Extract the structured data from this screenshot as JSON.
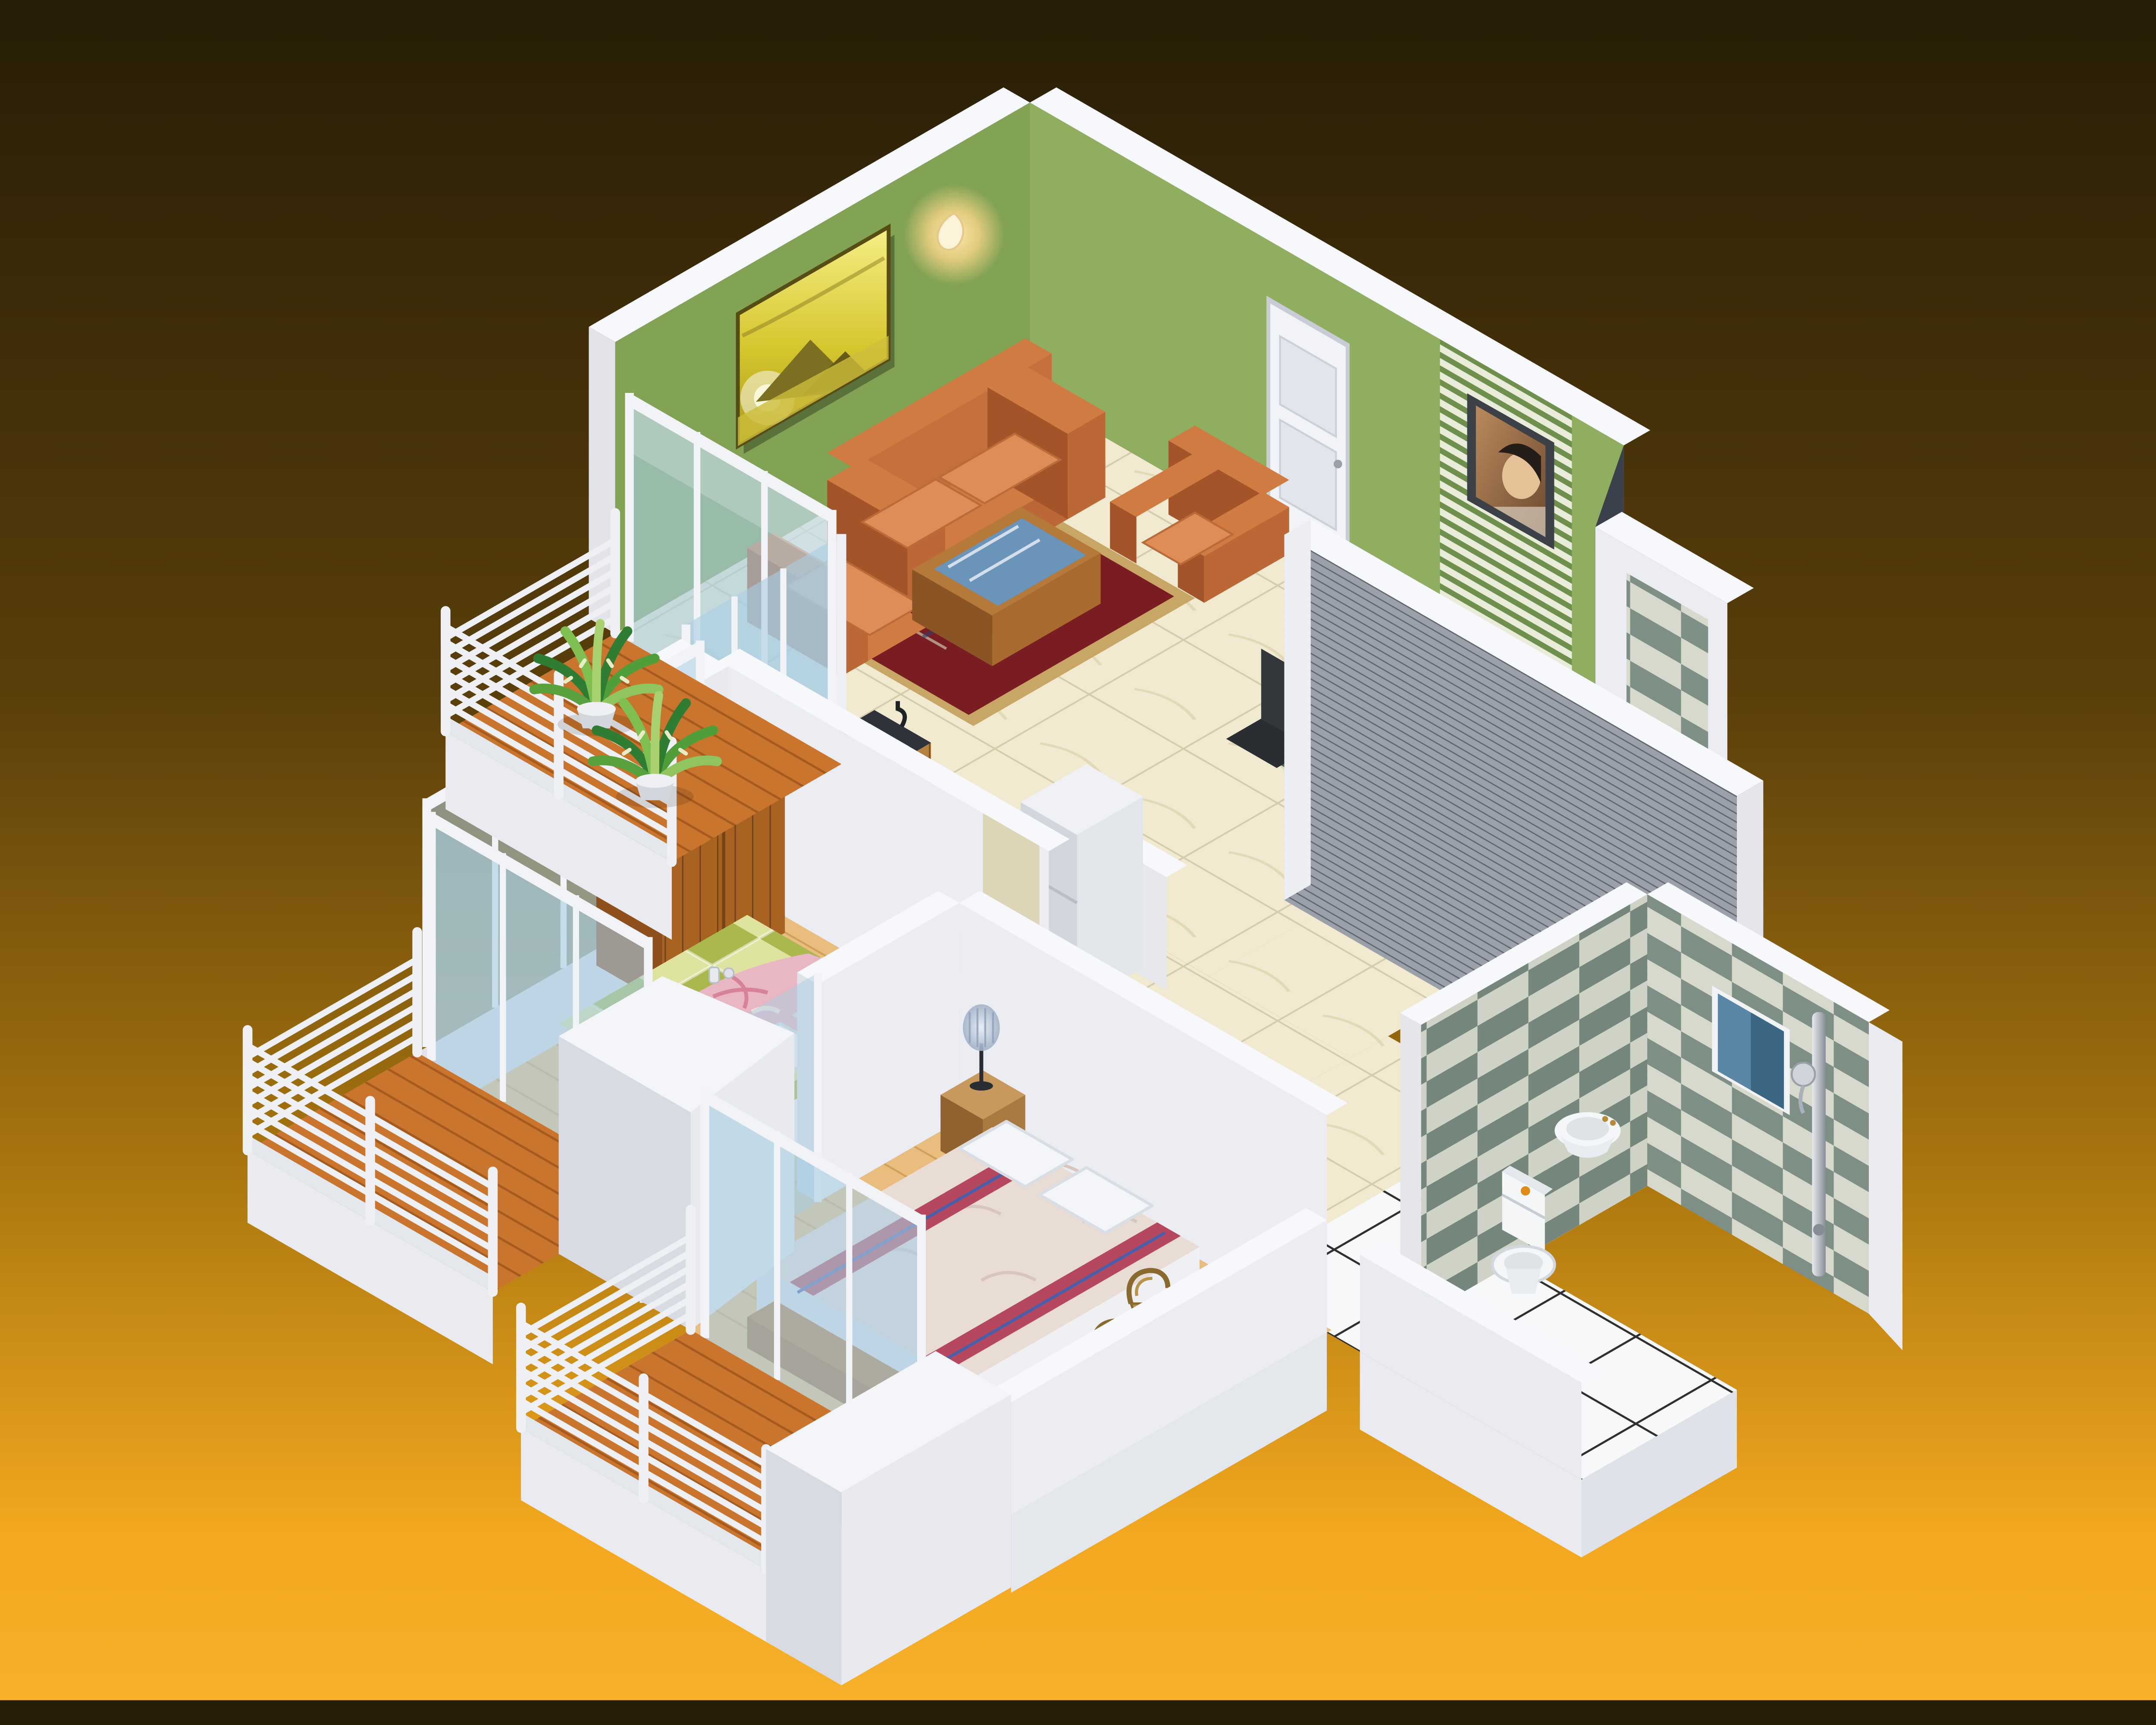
{
  "scene": {
    "type": "3d-isometric-architectural-render",
    "subject": "Two-bedroom apartment cutaway floor plan with furnished rooms and balconies",
    "projection": "isometric",
    "background": "dark brown to amber-orange vertical gradient",
    "text_on_screen": ""
  },
  "palette": {
    "bg_top": "#281e07",
    "bg_mid": "#5a3f0b",
    "bg_amber": "#a8750f",
    "bg_bottom": "#f2a81f",
    "wall_green": "#8fae60",
    "wall_green_shaded": "#82a254",
    "wall_white": "#ecedf2",
    "wall_cap": "#f7f8fb",
    "gray_feature_wall": "#9ba1aa",
    "gray_feature_stripe": "#61656e",
    "marble_floor": "#f1ead0",
    "bedroom_wood": "#e9bd7e",
    "balcony_wood": "#c9752d",
    "tile_white": "#f7f8fa",
    "checker_green": "#7e8f85",
    "checker_cream": "#d6d9cc",
    "sofa_orange": "#c06a38",
    "rug_red": "#7a1d22",
    "rug_border": "#c8a665",
    "mat_blue": "#3d5a9e",
    "table_plaid_green": "#3f6b52",
    "chair_black": "#33373c",
    "counter_black": "#303239",
    "cabinet_wood": "#b5823f",
    "fridge_white": "#eff1f5",
    "wardrobe_wood": "#a86323",
    "bed1_green": "#aab84e",
    "bed1_green_light": "#dfe3a0",
    "blanket_pink": "#e9b7c3",
    "bed2_cream": "#e9dcd4",
    "bed2_stripe_red": "#b5485e",
    "bed2_stripe_blue": "#4a5fa8",
    "wicker_tan": "#b89448",
    "glass_blue": "#a9cde2",
    "window_blue": "#5b87a6",
    "door_white": "#f2f3f6",
    "tv_frame": "#3c4148",
    "painting_gold": "#d6c62e",
    "plant_green": "#4f9e3a",
    "porcelain_white": "#f4f6f8",
    "lamp_shade_blue": "#b9c6d6",
    "accent_purple": "#7b2bd6",
    "accent_teal": "#2f9ea8",
    "button_orange": "#e08a1a"
  },
  "rooms": [
    {
      "name": "Living Room",
      "walls": "green",
      "floor": "cream marble tile",
      "contents": [
        "orange fabric sofa",
        "two orange armchairs",
        "wooden coffee table with blue glass top",
        "red oriental rug",
        "blue accent mat",
        "golden pyramids wall art",
        "glowing wall sconce",
        "white panel door"
      ]
    },
    {
      "name": "Dining Area",
      "contents": [
        "table with green plaid tablecloth",
        "place settings with plates and bowls",
        "wine bottle and glasses",
        "black dining chairs",
        "wall-mounted TV on green striped panel"
      ]
    },
    {
      "name": "Kitchen",
      "contents": [
        "black L-shaped counter",
        "white 4-burner gas hob",
        "inset sink with faucet",
        "wood-front base cabinets",
        "white refrigerator"
      ]
    },
    {
      "name": "Hallway",
      "contents": [
        "tall gray ribbed feature wall",
        "marble tile floor",
        "diamond-tiled wall section"
      ]
    },
    {
      "name": "Bedroom 1",
      "floor": "light oak plank",
      "contents": [
        "double bed with green checkered spread",
        "pink floral throw",
        "white pillows",
        "wooden wardrobe",
        "two nightstands with beaded lamps",
        "teal alarm clock",
        "purple photo frame",
        "wicker chair"
      ]
    },
    {
      "name": "Bedroom 2",
      "floor": "light oak plank",
      "contents": [
        "double bed with cream spread and striped bands",
        "white pillows",
        "nightstand with beaded lamp",
        "two wicker chairs",
        "wooden bench"
      ]
    },
    {
      "name": "Bathroom",
      "contents": [
        "green and cream diamond tiled walls",
        "blue window",
        "corner wash basin",
        "white toilet",
        "chrome shower column",
        "white tile floor with dark grout"
      ]
    },
    {
      "name": "Balcony 1",
      "contents": [
        "two potted plants",
        "orange wood deck",
        "white tubular railing",
        "sliding glass doors"
      ]
    },
    {
      "name": "Balcony 2",
      "contents": [
        "orange wood deck",
        "white tubular railing",
        "sliding glass doors"
      ]
    },
    {
      "name": "Balcony 3",
      "contents": [
        "orange wood deck",
        "white tubular railing",
        "sliding glass doors"
      ]
    }
  ]
}
